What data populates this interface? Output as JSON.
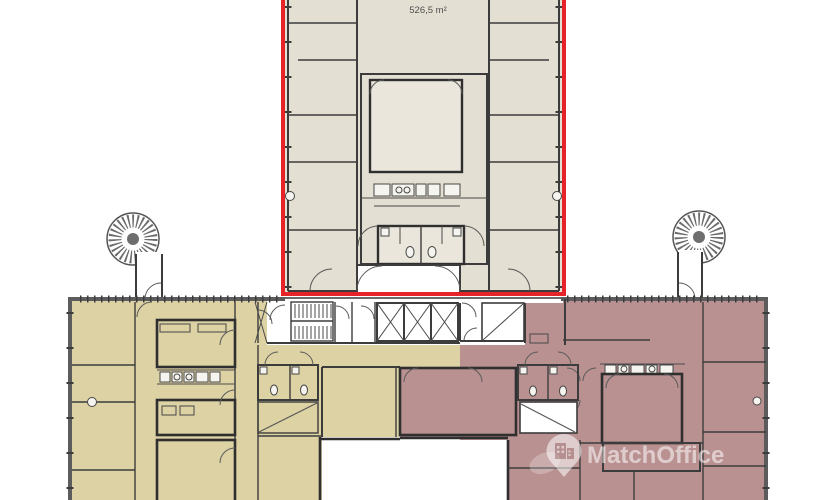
{
  "floorplan": {
    "unit": {
      "area_label": "526,5 m²"
    },
    "watermark": {
      "brand": "MatchOffice"
    },
    "colors": {
      "highlight_outline": "#e52329",
      "upper_unit_fill": "#e4dfd3",
      "left_wing_fill": "#ddd2a4",
      "right_wing_fill": "#b99191",
      "inner_room_fill": "#eae6db",
      "wall": "#3c3c3c"
    }
  }
}
